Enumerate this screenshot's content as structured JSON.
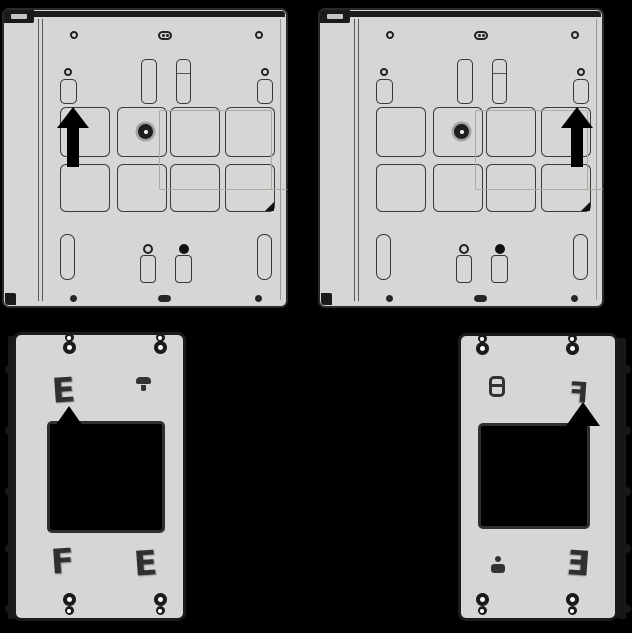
{
  "canvas": {
    "width": 632,
    "height": 633,
    "background": "#000000"
  },
  "colors": {
    "bg": "#000000",
    "panel_fill": "#d6d6d6",
    "outline": "#2a2a2a",
    "line_soft": "#5a5a5a",
    "ghost": "#b2aa9e",
    "arrow": "#000000",
    "window_fill": "#000000"
  },
  "figure": {
    "type": "installation-diagram",
    "parts": [
      {
        "id": "rear-panel-left",
        "description": "rear mounting plate with knockout grid",
        "arrow_direction": "up",
        "arrow_side": "left",
        "knockout_grid": {
          "rows": 2,
          "cols": 4
        }
      },
      {
        "id": "rear-panel-right",
        "description": "rear mounting plate with knockout grid",
        "arrow_direction": "up",
        "arrow_side": "right",
        "knockout_grid": {
          "rows": 2,
          "cols": 4
        }
      },
      {
        "id": "bracket-left",
        "description": "wall bracket with window cutout and corner keyhole slots",
        "arrow_direction": "up",
        "arrow_side": "window-top-left"
      },
      {
        "id": "bracket-right",
        "description": "wall bracket with window cutout and corner keyhole slots",
        "arrow_direction": "up",
        "arrow_side": "window-top-right"
      }
    ]
  },
  "glyphs": {
    "clip_e": "E",
    "clip_f": "F"
  }
}
